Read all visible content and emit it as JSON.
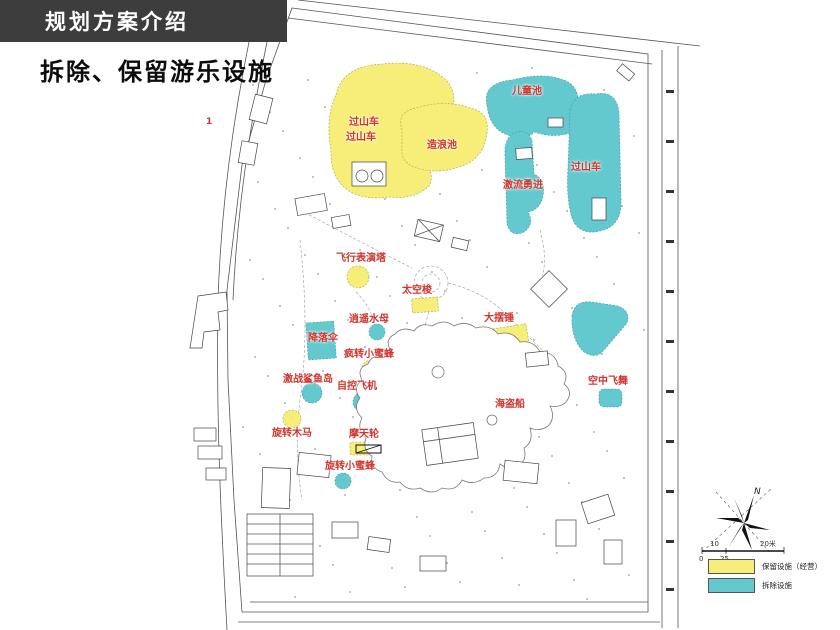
{
  "header": {
    "title": "规划方案介绍"
  },
  "subtitle": {
    "text": "拆除、保留游乐设施"
  },
  "map": {
    "marker_number": "1",
    "labels": [
      {
        "text": "过山车",
        "zone_color": "yellow"
      },
      {
        "text": "过山车",
        "zone_color": "yellow"
      },
      {
        "text": "造浪池",
        "zone_color": "yellow"
      },
      {
        "text": "儿童池",
        "zone_color": "cyan"
      },
      {
        "text": "激流勇进",
        "zone_color": "cyan"
      },
      {
        "text": "过山车",
        "zone_color": "cyan"
      },
      {
        "text": "飞行表演塔",
        "zone_color": "yellow"
      },
      {
        "text": "太空梭",
        "zone_color": "yellow"
      },
      {
        "text": "逍遥水母",
        "zone_color": "cyan"
      },
      {
        "text": "降落伞",
        "zone_color": "cyan"
      },
      {
        "text": "疯转小蜜蜂",
        "zone_color": "yellow"
      },
      {
        "text": "激战鲨鱼岛",
        "zone_color": "cyan"
      },
      {
        "text": "自控飞机",
        "zone_color": "cyan"
      },
      {
        "text": "旋转木马",
        "zone_color": "yellow"
      },
      {
        "text": "摩天轮",
        "zone_color": "yellow"
      },
      {
        "text": "旋转小蜜蜂",
        "zone_color": "cyan"
      },
      {
        "text": "海盗船",
        "zone_color": "yellow"
      },
      {
        "text": "大摆锤",
        "zone_color": "yellow"
      },
      {
        "text": "空中飞舞",
        "zone_color": "cyan"
      }
    ]
  },
  "legend": {
    "items": [
      {
        "label": "保留设施（经营）",
        "color": "#f6ee79"
      },
      {
        "label": "拆除设施",
        "color": "#63c9cf"
      }
    ]
  },
  "compass": {
    "north_label": "N"
  },
  "scale_bar": {
    "labels": [
      "10",
      "20米",
      "0",
      "25"
    ]
  },
  "colors": {
    "header_bg": "#3d3d3d",
    "retain_yellow": "#f6ee79",
    "demolish_cyan": "#63c9cf",
    "label_red": "#d0342c"
  }
}
